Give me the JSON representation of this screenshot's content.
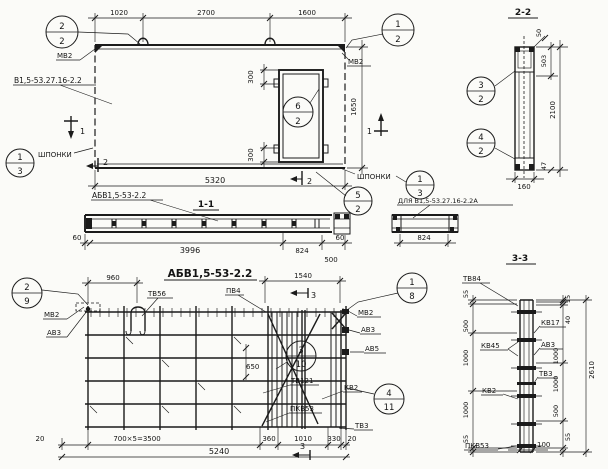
{
  "elevation": {
    "mark_label": "В1,5-53.27.16-2.2",
    "mv2_left": "МВ2",
    "mv2_right": "МВ2",
    "keys_left": "ШПОНКИ",
    "keys_right": "ШПОНКИ",
    "dim_1020": "1020",
    "dim_2700": "2700",
    "dim_1600": "1600",
    "dim_5320": "5320",
    "dim_1650": "1650",
    "dim_300_top": "300",
    "dim_300_bottom": "300",
    "sec_mark_1": "1",
    "sec_mark_2": "2",
    "callouts": {
      "top_left": [
        "2",
        "2"
      ],
      "top_right": [
        "1",
        "2"
      ],
      "opening": [
        "6",
        "2"
      ],
      "keys_left": [
        "1",
        "3"
      ],
      "keys_right": [
        "1",
        "3"
      ],
      "bottom": [
        "5",
        "2"
      ]
    }
  },
  "section_1_1": {
    "title": "1-1",
    "label": "АБВ1,5-53-2.2",
    "dim_60_left": "60",
    "dim_3996": "3996",
    "dim_824": "824",
    "dim_500": "500",
    "dim_60_right": "60",
    "alt_label": "ДЛЯ В1,5-53.27.16-2.2А",
    "alt_dim_824": "824"
  },
  "section_2_2": {
    "title": "2-2",
    "dim_50": "50",
    "dim_503": "503",
    "dim_2100": "2100",
    "dim_47": "47",
    "dim_160": "160",
    "callout_3": [
      "3",
      "2"
    ],
    "callout_4": [
      "4",
      "2"
    ]
  },
  "cage": {
    "title": "АБВ1,5-53-2.2",
    "dim_960": "960",
    "dim_1540": "1540",
    "dim_650": "650",
    "sec_mark_3": "3",
    "labels": {
      "tv56": "ТВ56",
      "pv4": "ПВ4",
      "mv2_left": "МВ2",
      "av3_left": "АВ3",
      "mv2_right": "МВ2",
      "av3_right": "АВ3",
      "av5": "АВ5",
      "tv121": "ТВ121",
      "kv2": "КВ2",
      "pkv53": "ПКВ53",
      "tv3": "ТВ3"
    },
    "callouts": {
      "c29": [
        "2",
        "9"
      ],
      "c18": [
        "1",
        "8"
      ],
      "c310": [
        "3",
        "10"
      ],
      "c411": [
        "4",
        "11"
      ]
    },
    "dims_bottom": [
      "20",
      "700×5=3500",
      "360",
      "1010",
      "330",
      "20"
    ],
    "dim_total": "5240"
  },
  "section_3_3": {
    "title": "3-3",
    "labels": {
      "tv84": "ТВ84",
      "kv17": "КВ17",
      "av3": "АВ3",
      "kv45": "КВ45",
      "kv2": "КВ2",
      "tv3": "ТВ3",
      "pkv53": "ПКВ53"
    },
    "dims_left": [
      "55",
      "500",
      "1000",
      "1000",
      "55"
    ],
    "dims_right": [
      "15",
      "40",
      "1000",
      "1000",
      "500",
      "55"
    ],
    "dim_total": "2610",
    "dim_100": "100"
  }
}
